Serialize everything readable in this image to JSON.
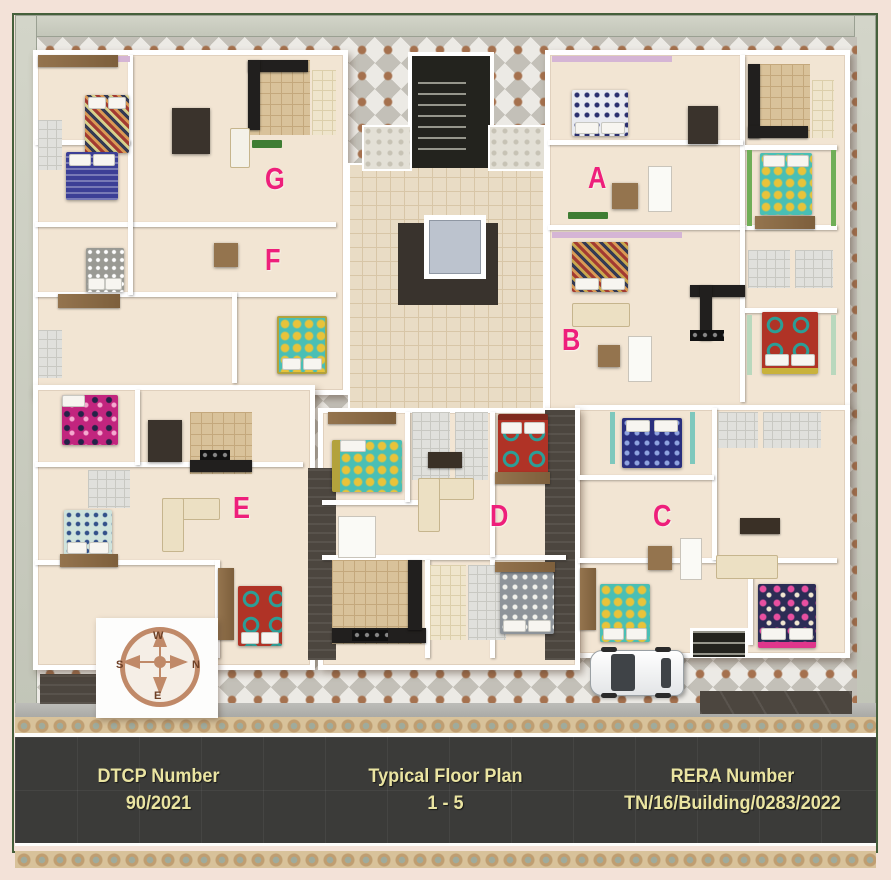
{
  "title": "Typical Floor Plan",
  "units": [
    {
      "label": "A"
    },
    {
      "label": "B"
    },
    {
      "label": "C"
    },
    {
      "label": "D"
    },
    {
      "label": "E"
    },
    {
      "label": "F"
    },
    {
      "label": "G"
    }
  ],
  "compass": {
    "north": "N",
    "south": "S",
    "east": "E",
    "west": "W"
  },
  "banner": {
    "dtcp_label": "DTCP Number",
    "dtcp_value": "90/2021",
    "plan_title": "Typical Floor Plan",
    "plan_floors": "1 - 5",
    "rera_label": "RERA Number",
    "rera_value": "TN/16/Building/0283/2022"
  },
  "colors": {
    "unit_label": "#ee1f7b",
    "banner_text": "#eae4a1",
    "banner_bg": "#3b3b39",
    "compass": "#c08968",
    "frame_border": "#45603b",
    "compound_wall": "#c9ccc0"
  }
}
